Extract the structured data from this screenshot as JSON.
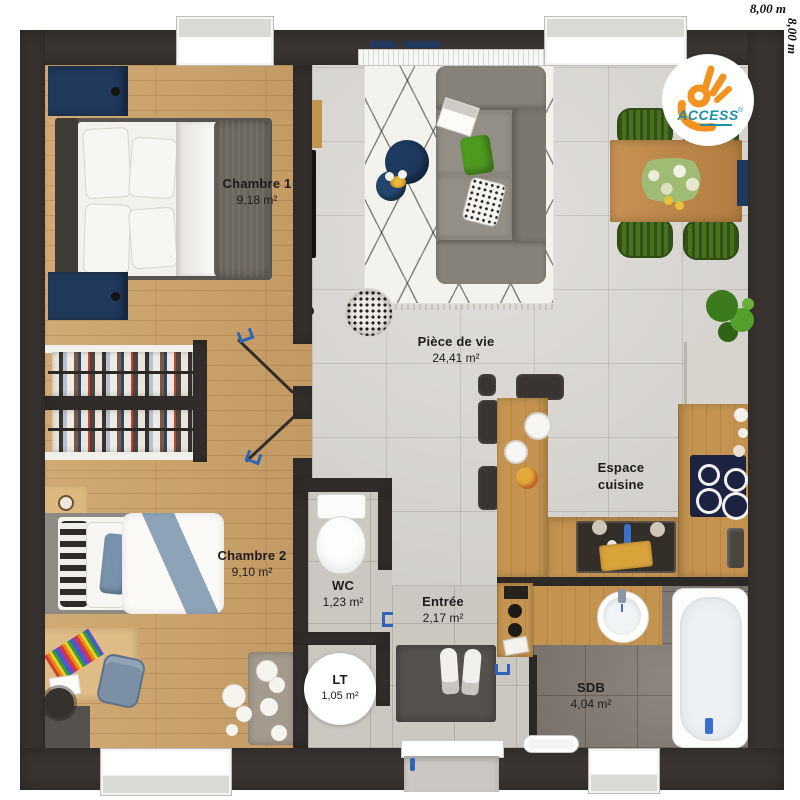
{
  "plan": {
    "dim_top": "8,00 m",
    "dim_right": "8,00 m"
  },
  "logo": {
    "brand": "ACCESS",
    "registered": "®"
  },
  "rooms": {
    "chambre1": {
      "name": "Chambre 1",
      "area": "9,18 m²"
    },
    "chambre2": {
      "name": "Chambre 2",
      "area": "9,10 m²"
    },
    "piece_de_vie": {
      "name": "Pièce de vie",
      "area": "24,41 m²"
    },
    "espace_cuisine": {
      "line1": "Espace",
      "line2": "cuisine"
    },
    "wc": {
      "name": "WC",
      "area": "1,23 m²"
    },
    "entree": {
      "name": "Entrée",
      "area": "2,17 m²"
    },
    "lt": {
      "name": "LT",
      "area": "1,05 m²"
    },
    "sdb": {
      "name": "SDB",
      "area": "4,04 m²"
    }
  },
  "colors": {
    "wall": "#3a3532",
    "wood_floor": "#cda268",
    "tile_living": "#d7d4cf",
    "tile_bath": "#837b72",
    "accent_navy": "#20395c",
    "accent_green": "#47701f",
    "logo_orange": "#f39220",
    "logo_teal": "#1a8fa6",
    "handle_blue": "#2f63b8"
  }
}
